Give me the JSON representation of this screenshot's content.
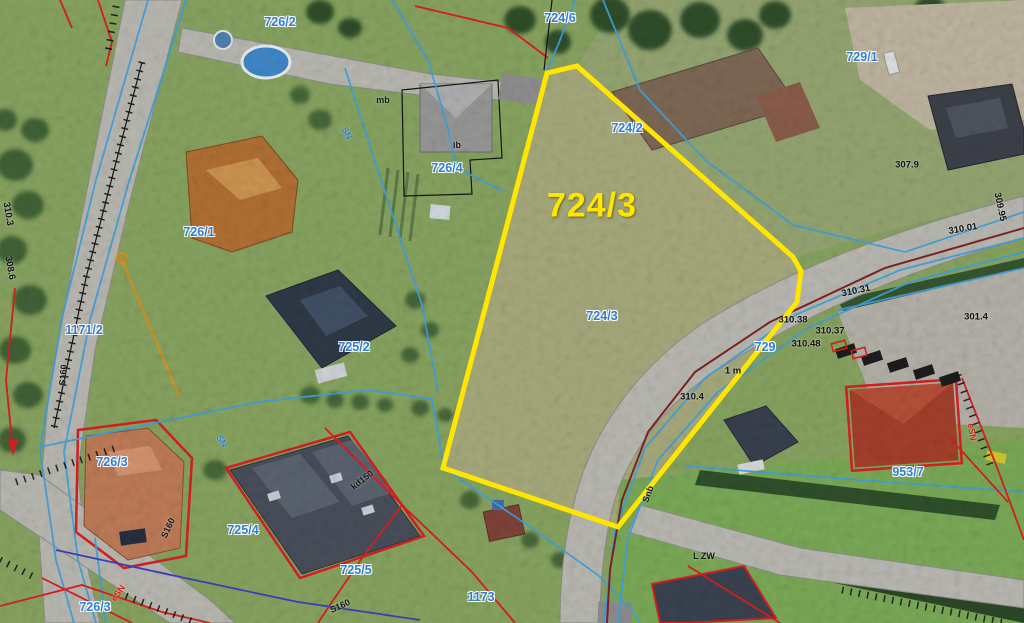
{
  "page": {
    "type": "aerial-cadastral-map",
    "description": "Orthophoto with cadastral overlay, parcel 724/3 highlighted"
  },
  "map": {
    "highlighted_parcel": {
      "id": "724/3",
      "polygon": "547,73 577,66 793,257 801,271 797,302 618,527 443,468",
      "label_x": 592,
      "label_y": 206
    },
    "parcel_labels": [
      {
        "text": "726/2",
        "x": 280,
        "y": 22
      },
      {
        "text": "724/6",
        "x": 560,
        "y": 18
      },
      {
        "text": "729/1",
        "x": 862,
        "y": 57
      },
      {
        "text": "724/2",
        "x": 627,
        "y": 128
      },
      {
        "text": "726/4",
        "x": 447,
        "y": 168
      },
      {
        "text": "726/1",
        "x": 199,
        "y": 232
      },
      {
        "text": "1171/2",
        "x": 84,
        "y": 330
      },
      {
        "text": "725/2",
        "x": 354,
        "y": 347
      },
      {
        "text": "724/3",
        "x": 602,
        "y": 316
      },
      {
        "text": "729",
        "x": 765,
        "y": 347
      },
      {
        "text": "726/3",
        "x": 112,
        "y": 462
      },
      {
        "text": "953/7",
        "x": 908,
        "y": 472
      },
      {
        "text": "725/4",
        "x": 243,
        "y": 530
      },
      {
        "text": "725/5",
        "x": 356,
        "y": 570
      },
      {
        "text": "1173",
        "x": 481,
        "y": 597
      },
      {
        "text": "726/3",
        "x": 95,
        "y": 607
      }
    ],
    "elevation_labels": [
      {
        "text": "310.31",
        "x": 856,
        "y": 291,
        "rot": -12
      },
      {
        "text": "310.38",
        "x": 793,
        "y": 320,
        "rot": 0
      },
      {
        "text": "310.37",
        "x": 830,
        "y": 331,
        "rot": 0
      },
      {
        "text": "310.48",
        "x": 806,
        "y": 344,
        "rot": 0
      },
      {
        "text": "307.9",
        "x": 907,
        "y": 165,
        "rot": 0
      },
      {
        "text": "309.95",
        "x": 1000,
        "y": 207,
        "rot": 78
      },
      {
        "text": "310.01",
        "x": 963,
        "y": 229,
        "rot": -10
      },
      {
        "text": "301.4",
        "x": 976,
        "y": 317,
        "rot": 0
      },
      {
        "text": "310.4",
        "x": 692,
        "y": 397,
        "rot": 0
      },
      {
        "text": "308.6",
        "x": 10,
        "y": 268,
        "rot": 80
      },
      {
        "text": "310.3",
        "x": 8,
        "y": 214,
        "rot": 80
      },
      {
        "text": "1 m",
        "x": 733,
        "y": 371,
        "rot": 0
      }
    ],
    "utility_labels": [
      {
        "text": "SN",
        "x": 347,
        "y": 133,
        "rot": 62,
        "color": "blue"
      },
      {
        "text": "SN",
        "x": 222,
        "y": 441,
        "rot": 55,
        "color": "blue"
      },
      {
        "text": "kd150",
        "x": 362,
        "y": 480,
        "rot": -38,
        "color": "black"
      },
      {
        "text": "S160",
        "x": 63,
        "y": 375,
        "rot": -85,
        "color": "black"
      },
      {
        "text": "S160",
        "x": 168,
        "y": 528,
        "rot": -65,
        "color": "black"
      },
      {
        "text": "S160",
        "x": 340,
        "y": 606,
        "rot": -25,
        "color": "black"
      },
      {
        "text": "eSN",
        "x": 118,
        "y": 593,
        "rot": -55,
        "color": "red"
      },
      {
        "text": "eSN",
        "x": 972,
        "y": 432,
        "rot": 80,
        "color": "red"
      },
      {
        "text": "mb",
        "x": 383,
        "y": 100,
        "rot": 0,
        "color": "black"
      },
      {
        "text": "ib",
        "x": 457,
        "y": 145,
        "rot": 0,
        "color": "black"
      },
      {
        "text": "L ZW",
        "x": 704,
        "y": 556,
        "rot": 0,
        "color": "black"
      },
      {
        "text": "Snb",
        "x": 648,
        "y": 494,
        "rot": -70,
        "color": "black"
      }
    ],
    "colors": {
      "highlight_yellow": "#ffe600",
      "parcel_label_blue": "#2d7dd2",
      "line_blue": "#3fa0dc",
      "line_red": "#d81f1f",
      "line_maroon": "#7c2424",
      "line_orange": "#dd8f1c",
      "line_navy": "#3d3dc0"
    }
  }
}
